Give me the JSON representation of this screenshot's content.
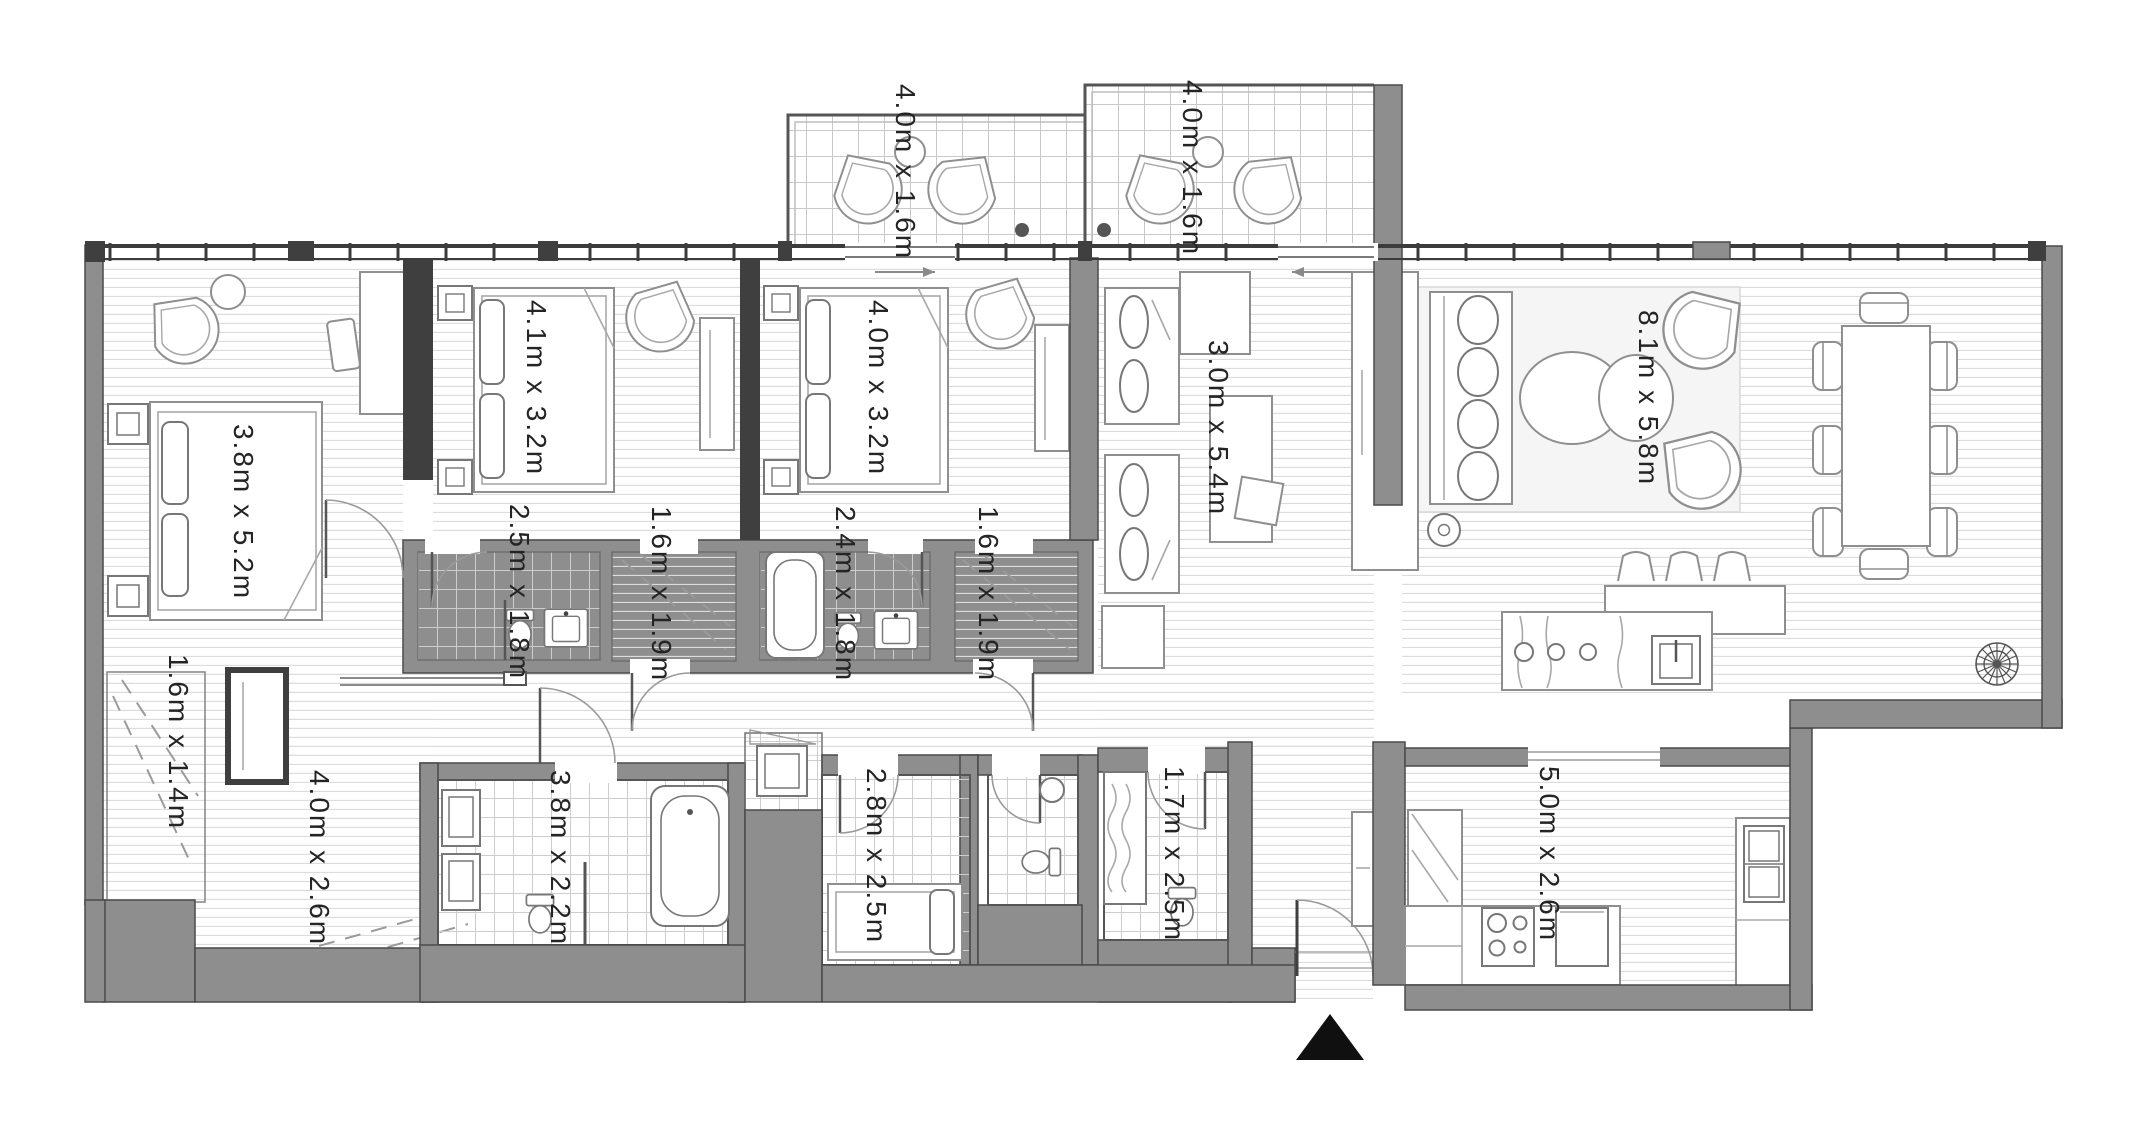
{
  "plan": {
    "type": "apartment-floor-plan",
    "rooms": [
      {
        "name": "balcony-left",
        "dimensions": "4.0m x 1.6m"
      },
      {
        "name": "balcony-right",
        "dimensions": "4.0m x 1.6m"
      },
      {
        "name": "bedroom-left",
        "dimensions": "3.8m x 5.2m"
      },
      {
        "name": "bedroom-middle",
        "dimensions": "4.1m x 3.2m"
      },
      {
        "name": "bedroom-right",
        "dimensions": "4.0m x 3.2m"
      },
      {
        "name": "family-room",
        "dimensions": "3.0m x 5.4m"
      },
      {
        "name": "living-dining-room",
        "dimensions": "8.1m x 5.8m"
      },
      {
        "name": "bathroom-middle-left",
        "dimensions": "2.5m x 1.8m"
      },
      {
        "name": "closet-middle-left",
        "dimensions": "1.6m x 1.9m"
      },
      {
        "name": "bathroom-middle-right",
        "dimensions": "2.4m x 1.8m"
      },
      {
        "name": "closet-middle-right",
        "dimensions": "1.6m x 1.9m"
      },
      {
        "name": "entry-closet",
        "dimensions": "1.6m x 1.4m"
      },
      {
        "name": "entry-hallway",
        "dimensions": "4.0m x 2.6m"
      },
      {
        "name": "master-bathroom",
        "dimensions": "3.8m x 2.2m"
      },
      {
        "name": "maid-room",
        "dimensions": "2.8m x 2.5m"
      },
      {
        "name": "utility-room",
        "dimensions": "1.7m x 2.5m"
      },
      {
        "name": "kitchen",
        "dimensions": "5.0m x 2.6m"
      }
    ],
    "icons": {
      "north_arrow": "solid black triangle marking the entrance / north",
      "rosette": "decorative compass rosette in living room corner"
    }
  },
  "colors": {
    "wall_gray": "#8e8e8e",
    "wall_dark": "#3f3f3f",
    "line_medium": "#8f8f8f",
    "line_light": "#d9d9d9",
    "label_color": "#242424",
    "north_arrow": "#101010"
  }
}
